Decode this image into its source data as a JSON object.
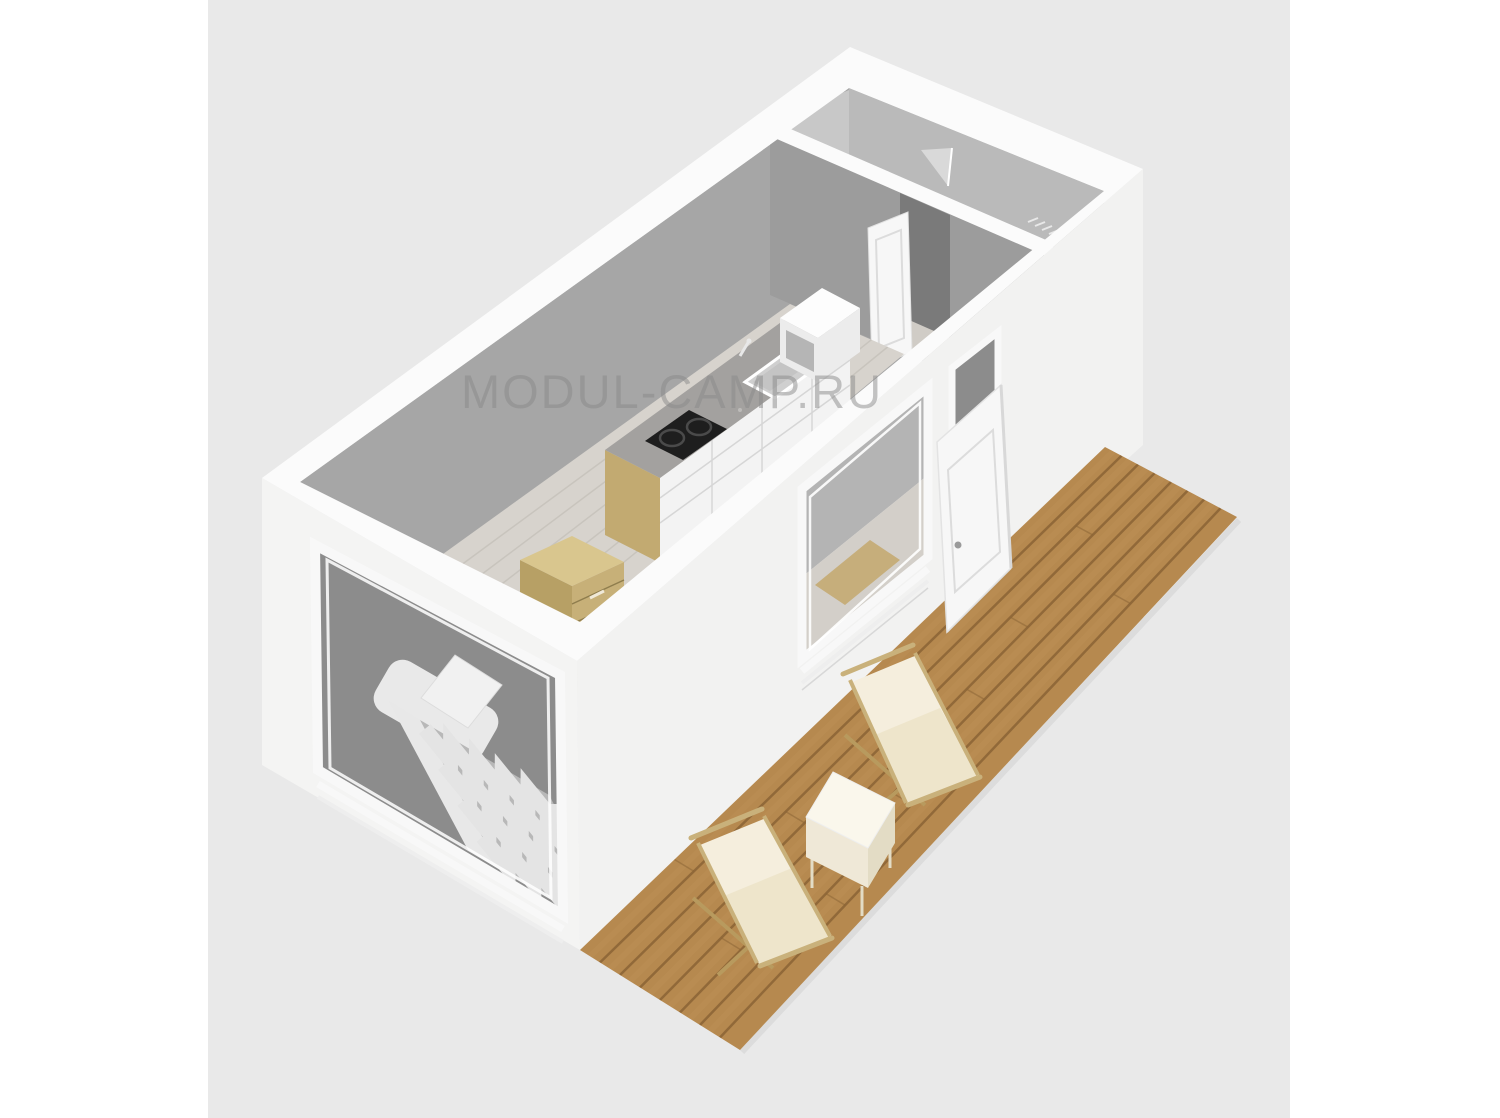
{
  "watermark": {
    "text": "MODUL-CAMP.RU",
    "color": "#8a8a8a",
    "opacity": 0.5
  },
  "canvas": {
    "page_background": "#ffffff",
    "image_background": "#e9e9e9"
  },
  "palette": {
    "wall_white": "#fbfbfb",
    "wall_ext_se": "#f2f2f1",
    "wall_ext_sw": "#f4f4f3",
    "interior_wall": "#a6a6a6",
    "interior_wall_light": "#bababa",
    "interior_wall_lighter": "#c8c8c8",
    "partition_face": "#9c9c9c",
    "bathroom_floor": "#b3b3b3",
    "shower_tray": "#d9d9d9",
    "floor": "#d7d3cd",
    "floor_line": "#c5c1ba",
    "reveal_dark": "#8c8c8c",
    "window_interior_gray": "#b4b4b4",
    "window_floor": "#d3cfc9",
    "window_wood": "#c6ae7b",
    "frame_white": "#f8f8f8",
    "door_white": "#f7f7f7",
    "door_panel_line": "#dcdcdc",
    "door_handle": "#9a9a9a",
    "door_gap_dark": "#6e6e6e",
    "door_floor_light": "#d0ccc6",
    "opening_dark": "#7a7a7a",
    "deck_wood": "#b6894f",
    "deck_gap": "#8d6637",
    "deck_light": "#c79d63",
    "deck_shadow": "#d9d9d9",
    "chair_canvas": "#f5eedd",
    "chair_canvas_shadow": "#e9dfc0",
    "chair_frame": "#c9b17b",
    "chair_frame_dark": "#b89a5e",
    "table_top": "#faf7ec",
    "table_side": "#efe8d7",
    "table_side_dark": "#e3dcc5",
    "counter_top": "#a3a19f",
    "counter_fleck": "#bdbbb9",
    "cabinet_front": "#f3f3f3",
    "cabinet_line": "#d6d6d6",
    "counter_end_wood": "#c2aa71",
    "cooktop": "#1e1e1e",
    "burner_ring": "#4a4a4a",
    "sink_inner": "#cfcfcf",
    "shelf_box_white": "#fdfdfd",
    "shelf_box_side": "#ececec",
    "shelf_box_slot": "#b5b5b5",
    "nightstand_top": "#d9c68e",
    "nightstand_front": "#c7b078",
    "nightstand_side": "#b7a065",
    "drawer_line": "#8f7d4d",
    "drawer_handle": "#f0e9d8",
    "bed_base": "#b8b8b8",
    "bed_zigzag": "#e4e4e4",
    "mattress": "#e8e8e8",
    "pillow": "#f1f1f1",
    "headboard": "#e9e9e9",
    "threshold": "#f0f0f0",
    "hatch_mark": "#e8e8e8"
  },
  "render": {
    "deck_plank_gaps": 7,
    "deck_butt_joints": 10,
    "floor_plank_lines": 6,
    "blanket_zigzag_rows": 4
  }
}
